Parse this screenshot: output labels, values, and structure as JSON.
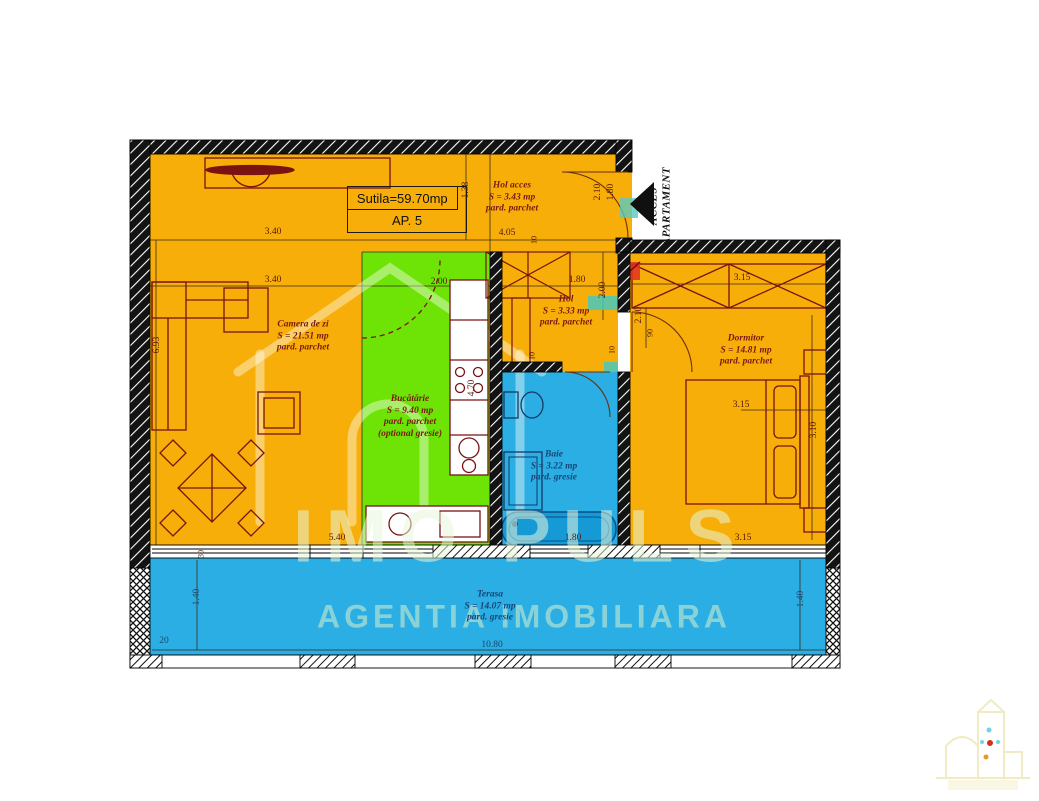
{
  "title_box": {
    "surface": "Sutila=59.70mp",
    "apartment": "AP. 5"
  },
  "access": {
    "line1": "ACCES",
    "line2": "APARTAMENT"
  },
  "rooms": {
    "hol_acces": {
      "name": "Hol acces",
      "area": "S = 3.43 mp",
      "floor": "pard. parchet"
    },
    "camera": {
      "name": "Camera de zi",
      "area": "S = 21.51 mp",
      "floor": "pard. parchet"
    },
    "bucatarie": {
      "name": "Bucătărie",
      "area": "S = 9.40 mp",
      "floor": "pard. parchet",
      "note": "(optional gresie)"
    },
    "hol": {
      "name": "Hol",
      "area": "S = 3.33 mp",
      "floor": "pard. parchet"
    },
    "dormitor": {
      "name": "Dormitor",
      "area": "S = 14.81 mp",
      "floor": "pard. parchet"
    },
    "baie": {
      "name": "Baie",
      "area": "S = 3.22 mp",
      "floor": "pard. gresie"
    },
    "terasa": {
      "name": "Terasa",
      "area": "S = 14.07 mp",
      "floor": "pard. gresie"
    }
  },
  "dims": {
    "a1": "3.40",
    "a2": "1.38",
    "a3": "4.05",
    "a4": "10",
    "a5": "2.10",
    "a6": "1.80",
    "b1": "3.40",
    "b2": "2.00",
    "b3": "1.80",
    "b4": "2.00",
    "b5": "3.15",
    "c1": "6.93",
    "c2": "4.70",
    "c3": "10",
    "c4": "10",
    "c5": "2.10",
    "c6": "90",
    "d1": "3.15",
    "d2": "3.10",
    "e1": "5.40",
    "e2": "1.80",
    "e3": "3.15",
    "e4": "30",
    "f1": "1.40",
    "f2": "1.40",
    "f3": "10.80",
    "f4": "20"
  },
  "watermark": {
    "brand": "IMO PULS",
    "tagline": "AGENTIA IMOBILIARA"
  },
  "colors": {
    "floor_orange": "#F8AE08",
    "floor_green": "#6EE406",
    "floor_blue": "#2AAEE4",
    "bathtub_blue": "#159AD6",
    "furniture_line": "#7A1212",
    "plumbing_teal": "#46C8BE",
    "riser_red": "#E03020"
  }
}
